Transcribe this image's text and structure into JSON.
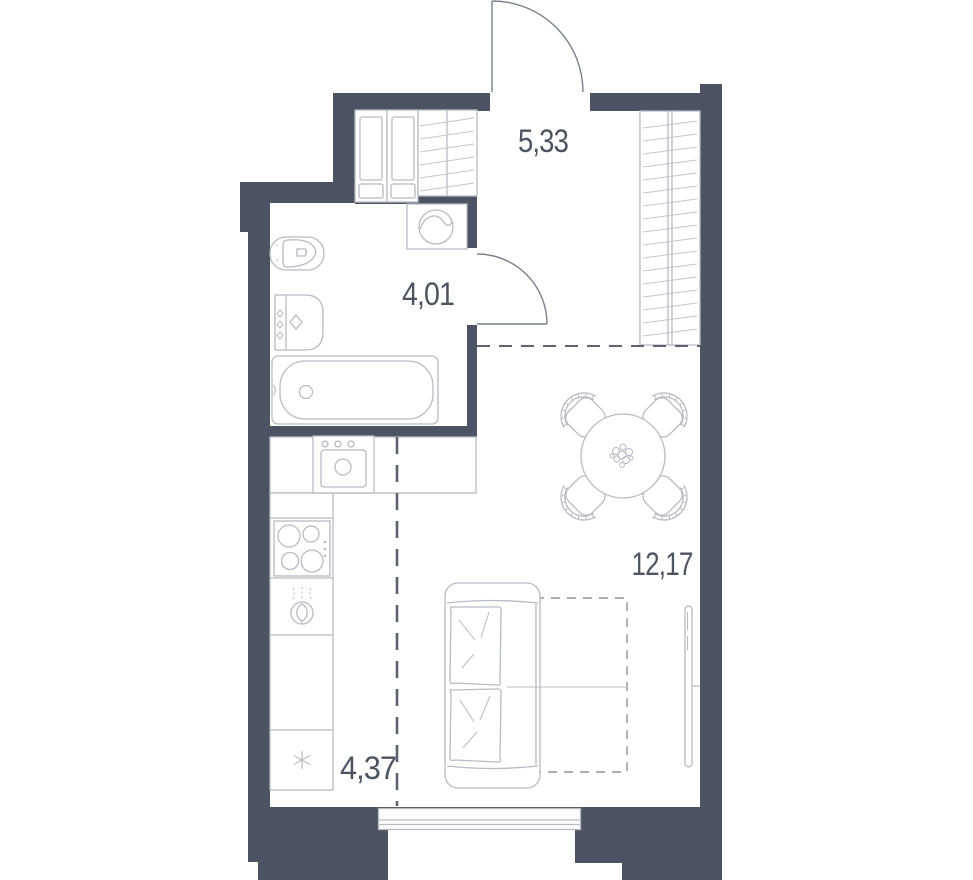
{
  "title": "studio-apartment-floor-plan",
  "colors": {
    "wall": "#4c5362",
    "fixture_stroke": "#b7bbc3",
    "hatch_stroke": "#c3c6cd",
    "door_stroke": "#7a808b",
    "dash_stroke": "#5d6470",
    "zone_dash": "#8f95a0",
    "label_text": "#4d5461",
    "background": "#ffffff"
  },
  "rooms": {
    "hallway": {
      "name": "hallway",
      "area": "5,33"
    },
    "bathroom": {
      "name": "bathroom",
      "area": "4,01"
    },
    "living_room": {
      "name": "living-room",
      "area": "12,17"
    },
    "kitchen": {
      "name": "kitchen-zone",
      "area": "4,37"
    }
  },
  "symbols": {
    "fridge_star": "✳"
  },
  "fixtures": [
    "entry-door",
    "bathroom-door",
    "wardrobe-cabinets",
    "wardrobe-shelves",
    "hall-closet",
    "washing-machine",
    "toilet",
    "washbasin",
    "bathtub",
    "kitchen-counter",
    "kitchen-sink",
    "stove",
    "cooker-hood",
    "fridge-star",
    "dining-table",
    "chairs",
    "sofa",
    "bed-zone",
    "tv",
    "window"
  ]
}
